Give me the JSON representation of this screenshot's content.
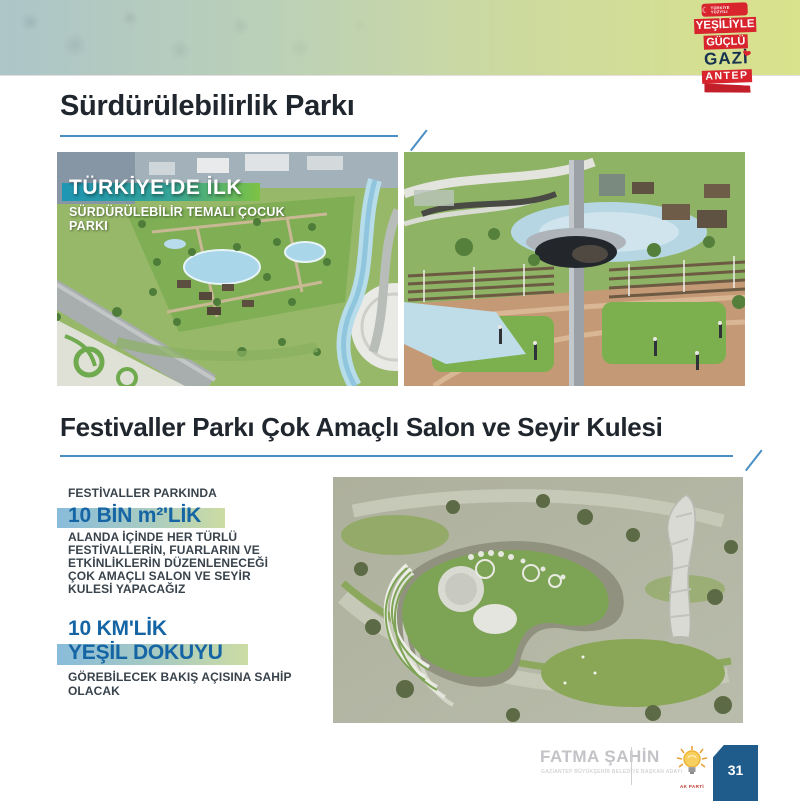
{
  "header": {
    "badge": {
      "turkiye_label": "TÜRKİYE YÜZYILI",
      "line1": "YEŞİLİYLE",
      "line2": "GÜÇLÜ",
      "city_top": "GAZİ",
      "city_bottom": "ANTEP"
    }
  },
  "section1": {
    "title": "Sürdürülebilirlik Parkı",
    "image1_overlay": {
      "headline": "TÜRKİYE'DE İLK",
      "subline1": "SÜRDÜRÜLEBİLİR TEMALI ÇOCUK",
      "subline2": "PARKI"
    }
  },
  "section2": {
    "title": "Festivaller Parkı Çok Amaçlı Salon ve Seyir Kulesi",
    "intro": "FESTİVALLER PARKINDA",
    "highlight1": "10 BİN m²'LİK",
    "body1_lines": [
      "ALANDA İÇİNDE HER TÜRLÜ",
      "FESTİVALLERİN, FUARLARIN VE",
      "ETKİNLİKLERİN DÜZENLENECEĞİ",
      "ÇOK AMAÇLI SALON VE SEYİR",
      "KULESİ YAPACAĞIZ"
    ],
    "highlight2_line1": "10 KM'LİK",
    "highlight2_line2": "YEŞİL DOKUYU",
    "body2_lines": [
      "GÖREBİLECEK BAKIŞ AÇISINA SAHİP",
      "OLACAK"
    ]
  },
  "footer": {
    "name": "FATMA ŞAHİN",
    "subtitle": "GAZİANTEP BÜYÜKŞEHİR BELEDİYE BAŞKAN ADAYI",
    "party": "AK PARTİ",
    "page_number": "31"
  },
  "colors": {
    "accent_underline_blue": "#4a8fc4",
    "highlight_text_blue": "#1565a5",
    "highlight_bar_left": "#89bcdb",
    "highlight_bar_right": "#ccdca3",
    "badge_red": "#d8242d",
    "badge_navy": "#16324f",
    "page_badge_blue": "#1f5c8b",
    "banner_gradient_left": "#b2cbcd",
    "banner_gradient_right": "#d9e28c"
  }
}
